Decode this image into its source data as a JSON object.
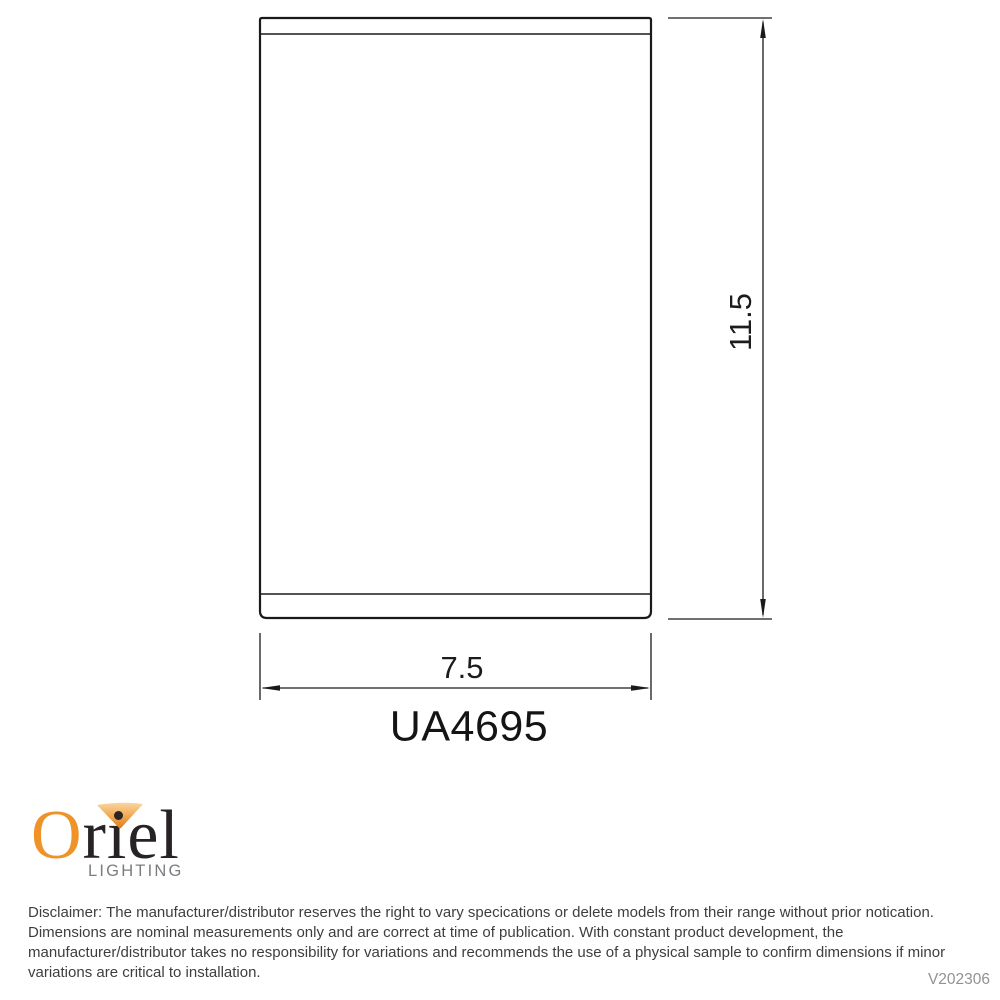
{
  "drawing": {
    "model_number": "UA4695",
    "width_dimension": "7.5",
    "height_dimension": "11.5",
    "line_color": "#1a1a1a"
  },
  "logo": {
    "brand_initial": "O",
    "brand_rest": "riel",
    "tagline": "LIGHTING",
    "colors": {
      "orange": "#EF9227",
      "fan_gradient_top": "#F9D6A0",
      "fan_gradient_bottom": "#E07C1C",
      "wordmark_dark": "#272223",
      "tagline_gray": "#7A7C7F"
    }
  },
  "footer": {
    "disclaimer_lines": [
      "Disclaimer: The manufacturer/distributor reserves the right to vary specications or delete models from their range without prior notication.",
      "Dimensions are nominal measurements only and are correct at time of publication. With constant product development, the",
      "manufacturer/distributor takes no responsibility for variations and recommends the use of a physical sample to confirm dimensions if minor",
      "variations are critical to installation."
    ],
    "version": "V202306"
  }
}
